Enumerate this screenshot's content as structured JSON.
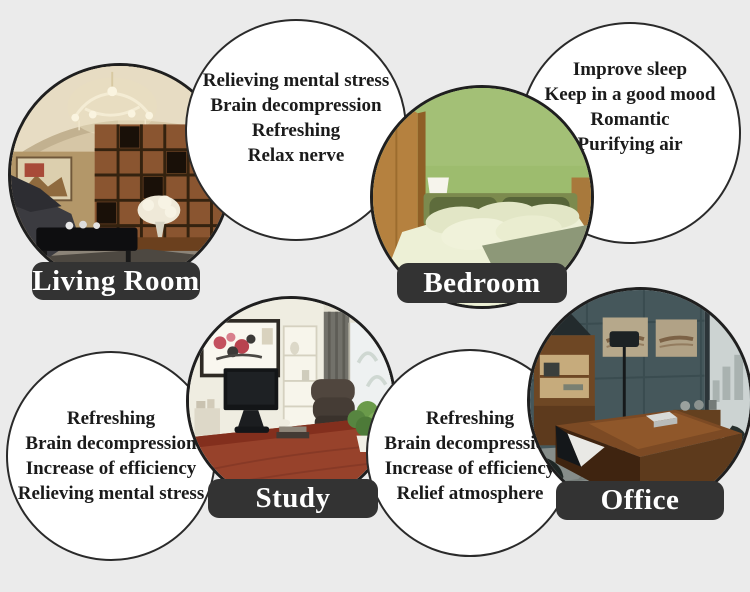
{
  "colors": {
    "background": "#ebebeb",
    "label_bg": "#333333",
    "label_text": "#ffffff",
    "bubble_bg": "#ffffff",
    "circle_outline": "#222222"
  },
  "sections": {
    "living_room": {
      "label": "Living Room",
      "benefits": [
        "Relieving mental stress",
        "Brain decompression",
        "Refreshing",
        "Relax nerve"
      ]
    },
    "bedroom": {
      "label": "Bedroom",
      "benefits": [
        "Improve sleep",
        "Keep in a good mood",
        "Romantic",
        "Purifying air"
      ]
    },
    "study": {
      "label": "Study",
      "benefits": [
        "Refreshing",
        "Brain decompression",
        "Increase of efficiency",
        "Relieving mental stress"
      ]
    },
    "office": {
      "label": "Office",
      "benefits": [
        "Refreshing",
        "Brain decompression",
        "Increase of efficiency",
        "Relief atmosphere"
      ]
    }
  }
}
